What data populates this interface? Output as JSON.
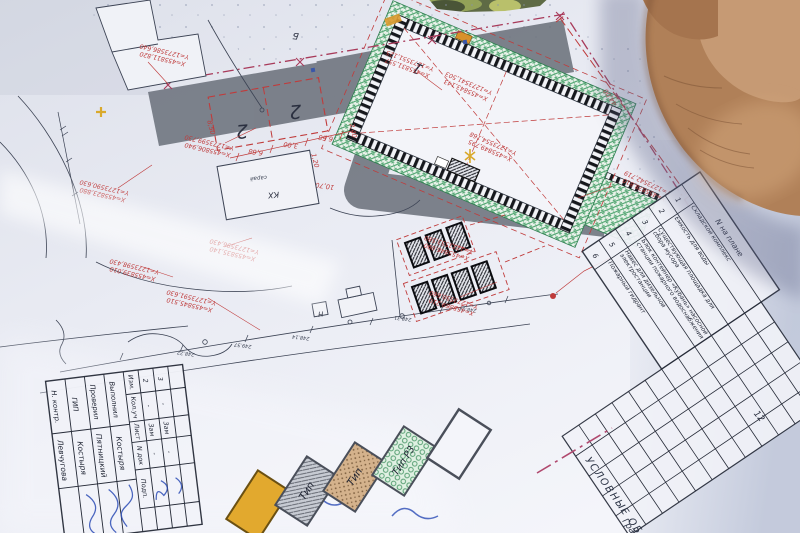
{
  "coords": [
    {
      "x": "X=455806,940",
      "y": "Y=1273599,730"
    },
    {
      "x": "X=455823,880",
      "y": "Y=1273590,630"
    },
    {
      "x": "X=455835,140",
      "y": "Y=1273596,430"
    },
    {
      "x": "X=455845,510",
      "y": "Y=1273591,630"
    },
    {
      "x": "X=455839,010",
      "y": "Y=1273598,430"
    },
    {
      "x": "X=455846,090",
      "y": "Y=1273553,580"
    },
    {
      "x": "X=455869,210",
      "y": "Y=1273550,660"
    },
    {
      "x": "X=455878,810",
      "y": "Y=1273542,719"
    },
    {
      "x": "X=455811,820",
      "y": "Y=1273586,640"
    },
    {
      "x": "X=455831,557",
      "y": "Y=1273551,125"
    },
    {
      "x": "X=455843,143",
      "y": "Y=1273541,503"
    },
    {
      "x": "X=455849,795",
      "y": "Y=1273554,168"
    }
  ],
  "dims": {
    "d4400": "44,00",
    "d1070": "10,70",
    "d120": "1,20",
    "d240": "2,40",
    "d850": "8,50",
    "d668a": "6,68",
    "d300": "3,00",
    "d668b": "6,68"
  },
  "labels": {
    "bldg1": "1",
    "park2a": "2",
    "park2b": "2",
    "kx": "КХ",
    "saray": "сарай",
    "b": "Б",
    "n": "Н",
    "row12": "12"
  },
  "elev": [
    "248.22",
    "249.57",
    "248.14",
    "248.31",
    "248.04"
  ],
  "table": {
    "header": "N на плане",
    "rows": [
      {
        "num": "1",
        "name": "Складской комплекс"
      },
      {
        "num": "2",
        "name": "Ёмкость для воды"
      },
      {
        "num": "3",
        "name": "Существующая площадка для сбора мусора"
      },
      {
        "num": "4",
        "name": "Блок контейнер «Кубань» насосной станции пожарного водоснабжения"
      },
      {
        "num": "5",
        "name": "Навес для дизельной электростанции"
      },
      {
        "num": "6",
        "name": "Пожарный гидрант"
      }
    ]
  },
  "stamp": {
    "cols": [
      "Изм.",
      "Кол.уч",
      "Лист",
      "N док",
      "Подп."
    ],
    "changes": [
      {
        "n": "2",
        "a": "-",
        "b": "Зам",
        "c": "-"
      },
      {
        "n": "3",
        "a": "-",
        "b": "Зам",
        "c": "-"
      }
    ],
    "roles": [
      {
        "role": "Выполнил",
        "name": "Костыря"
      },
      {
        "role": "Проверил",
        "name": "Пятницкий"
      },
      {
        "role": "ГИП",
        "name": "Костыря"
      },
      {
        "role": "Н. контр.",
        "name": "Левчугова"
      }
    ]
  },
  "legend": {
    "title": "УСЛОВНЫЕ ОБОЗН",
    "partial": "Гра",
    "t1": "Тип",
    "t2": "Тип",
    "t3": "Тип Р3"
  },
  "colors": {
    "red": "#bf3a3a",
    "crimson": "#a83a5a",
    "green": "#3f9e63",
    "road": "#696f79",
    "skin": "#b08058",
    "yellow": "#e2a92e",
    "blue_ink": "#2b4bb5"
  }
}
